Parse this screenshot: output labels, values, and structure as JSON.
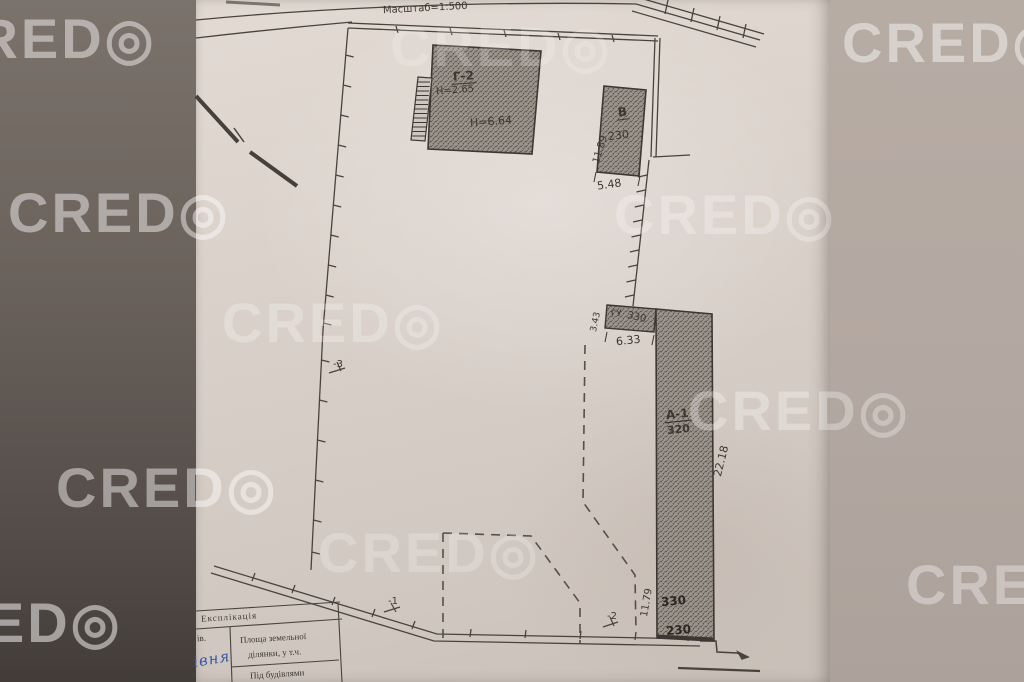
{
  "watermark": {
    "label": "CRED◎"
  },
  "plan": {
    "scale_note": "Масштаб=1:500",
    "buildings": {
      "top": {
        "label": "Г-2",
        "height_note": "Н=2.65",
        "height_note2": "Н=6.64"
      },
      "small": {
        "label": "В",
        "value": "230",
        "dim_side": "11.89",
        "dim_bottom": "5.48"
      },
      "utility": {
        "label": "ГУ",
        "value": "330",
        "dim_side": "3.43",
        "dim_bottom": "6.33"
      },
      "long": {
        "label": "А-1",
        "value": "320",
        "dim_side": "22.18",
        "dim_side2": "11.79",
        "value2": "330",
        "value3": "230"
      }
    },
    "marks": {
      "fence_left": "-3",
      "road": "-1",
      "corner": "-2"
    }
  },
  "table": {
    "title": "Експлікація",
    "col1_fragment": "ів.",
    "row1_line1": "Площа земельної",
    "row1_line2": "ділянки, у т.ч.",
    "row2": "Під будівлями",
    "handwriting_fragment": "івня"
  },
  "colors": {
    "ink": "#3d3732",
    "paper": "#d8cfc8",
    "background_left": "#6b625c",
    "background_right": "#b5aaa3",
    "handwriting_blue": "#3b55a8",
    "watermark": "#ffffff"
  }
}
